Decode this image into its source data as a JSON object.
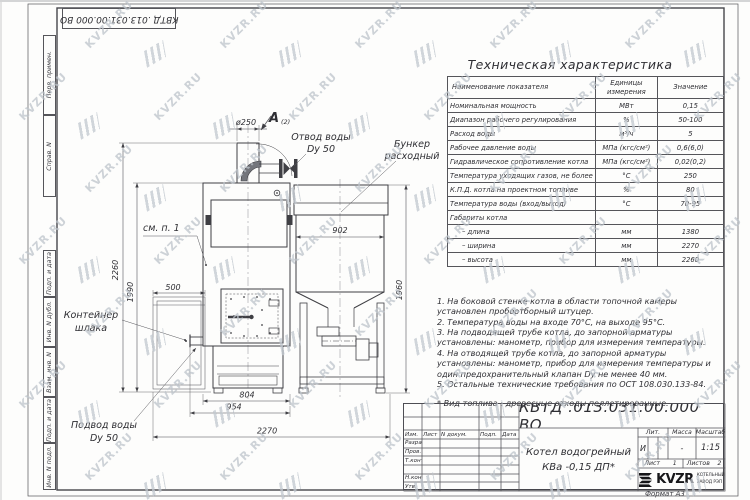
{
  "sheet": {
    "designation_top": "КВТД .013.031.00.000 ВО",
    "format_note": "Формат А3",
    "watermark_text": "KVZR.RU"
  },
  "frame_left_labels": [
    "Перв. примен.",
    "Справ. N",
    "Подп. и дата",
    "Инв. N дубл.",
    "Взам. инв. N",
    "Подп. и дата",
    "Инв. N подл."
  ],
  "spec_table": {
    "title": "Техническая характеристика",
    "col_name": "Наименование показателя",
    "col_units": "Единицы измерения",
    "col_value": "Значение",
    "rows": [
      {
        "name": "Номинальная мощность",
        "units": "МВт",
        "value": "0,15"
      },
      {
        "name": "Диапазон рабочего регулирования",
        "units": "%",
        "value": "50-100"
      },
      {
        "name": "Расход воды",
        "units": "м³/ч",
        "value": "5"
      },
      {
        "name": "Рабочее давление воды",
        "units": "МПа (кгс/см²)",
        "value": "0,6(6,0)"
      },
      {
        "name": "Гидравлическое сопротивление котла",
        "units": "МПа (кгс/см²)",
        "value": "0,02(0,2)"
      },
      {
        "name": "Температура уходящих газов, не более",
        "units": "°С",
        "value": "250"
      },
      {
        "name": "К.П.Д. котла на проектном топливе",
        "units": "%",
        "value": "80"
      },
      {
        "name": "Температура воды (вход/выход)",
        "units": "°С",
        "value": "70-95"
      },
      {
        "name": "Габариты котла",
        "units": "",
        "value": ""
      },
      {
        "name": "– длина",
        "units": "мм",
        "value": "1380"
      },
      {
        "name": "– ширина",
        "units": "мм",
        "value": "2270"
      },
      {
        "name": "– высота",
        "units": "мм",
        "value": "2260"
      }
    ]
  },
  "notes": [
    "1. На боковой стенке котла в области топочной камеры установлен пробоотборный штуцер.",
    "2. Температура воды на входе 70°С, на выходе 95°С.",
    "3. На подводящей трубе котла, до запорной арматуры установлены: манометр, прибор для измерения температуры.",
    "4. На отводящей трубе котла, до запорной арматуры установлены: манометр, прибор для измерения температуры и один предохранительный клапан Dу не менее 40 мм.",
    "5. Остальные технические требования по ОСТ 108.030.133-84."
  ],
  "fuel_note": "* Вид топлива : древесные отходы пеллетированные.",
  "drawing": {
    "labels": {
      "outlet_1": "Отвод воды",
      "outlet_2": "Dy 50",
      "bunker_1": "Бункер",
      "bunker_2": "расходный",
      "see_note": "см. п. 1",
      "container_1": "Контейнер",
      "container_2": "шлака",
      "inlet_1": "Подвод воды",
      "inlet_2": "Dy 50",
      "view": "A",
      "view_sheet": "(2)"
    },
    "dims": {
      "height_total": "2260",
      "height_body": "1990",
      "container_width": "500",
      "bunker_width": "902",
      "bunker_height": "1960",
      "chimney_dia": "ø250",
      "base_width": "804",
      "mid_width": "954",
      "overall_width": "2270"
    }
  },
  "title_block": {
    "designation": "КВТД .013.031.00.000  ВО",
    "name_line1": "Котел водогрейный",
    "name_line2": "КВа -0,15  ДП*",
    "header_cols": [
      "Изм.",
      "Лист",
      "N докум.",
      "Подп.",
      "Дата"
    ],
    "row_labels": [
      "Разраб.",
      "Пров.",
      "Т.контр.",
      "",
      "Н.контр.",
      "Утв."
    ],
    "lit_label": "Лит.",
    "mass_label": "Масса",
    "scale_label": "Масштаб",
    "lit_value": "И",
    "mass_value": "-",
    "scale_value": "1:15",
    "sheet_label": "Лист",
    "sheet_value": "1",
    "sheets_label": "Листов",
    "sheets_value": "2",
    "brand": "KVZR",
    "brand_line1": "КОТЕЛЬНЫЙ",
    "brand_line2": "ЗАВОД РЭП"
  }
}
